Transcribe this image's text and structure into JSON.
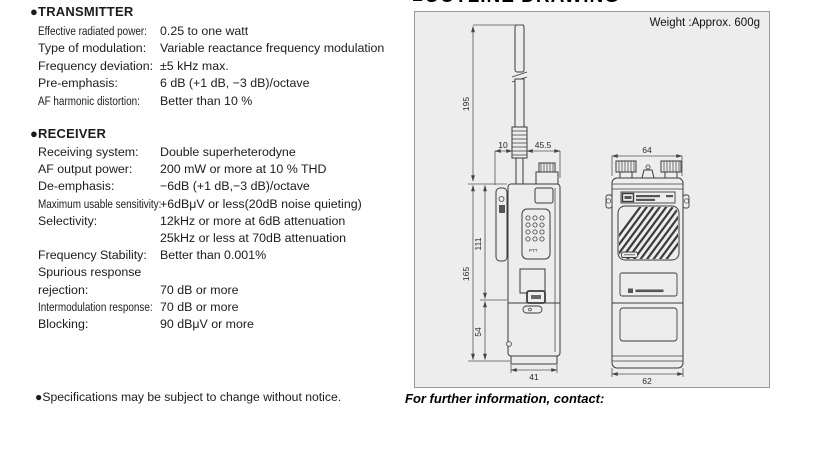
{
  "page": {
    "outline_header": "■OUTLINE DRAWING",
    "weight_note": "Weight :Approx. 600g",
    "footnote": "●Specifications may be subject to change without notice.",
    "contact_note": "For further information, contact:"
  },
  "transmitter": {
    "title": "●TRANSMITTER",
    "rows": [
      {
        "label": "Effective radiated power:",
        "value": "0.25 to one watt"
      },
      {
        "label": "Type of modulation:",
        "value": "Variable reactance frequency modulation"
      },
      {
        "label": "Frequency deviation:",
        "value": "±5 kHz max."
      },
      {
        "label": "Pre-emphasis:",
        "value": "6 dB (+1 dB, −3 dB)/octave"
      },
      {
        "label": "AF harmonic distortion:",
        "value": "Better than 10 %"
      }
    ]
  },
  "receiver": {
    "title": "●RECEIVER",
    "rows": [
      {
        "label": "Receiving system:",
        "value": "Double superheterodyne"
      },
      {
        "label": "AF output power:",
        "value": "200 mW or more at 10 % THD"
      },
      {
        "label": "De-emphasis:",
        "value": "−6dB (+1 dB,−3 dB)/octave"
      },
      {
        "label": "Maximum usable sensitivity:",
        "value": "+6dBμV or less(20dB noise quieting)"
      },
      {
        "label": "Selectivity:",
        "value": "12kHz or more at 6dB attenuation"
      },
      {
        "label": "",
        "value": "25kHz or less at 70dB attenuation"
      },
      {
        "label": "Frequency Stability:",
        "value": "Better than 0.001%"
      },
      {
        "label": "Spurious response",
        "value": ""
      },
      {
        "label": "rejection:",
        "value": "70 dB or more"
      },
      {
        "label": "Intermodulation response:",
        "value": "70 dB or more"
      },
      {
        "label": "Blocking:",
        "value": "90 dBμV or more"
      }
    ]
  },
  "drawing": {
    "dims": {
      "antenna_length": "195",
      "antenna_offset": "10",
      "side_top_width": "45.5",
      "front_top_width": "64",
      "upper_body_height": "111",
      "body_height": "165",
      "lower_body_height": "54",
      "side_bottom_width": "41",
      "front_bottom_width": "62"
    },
    "keypad_label": "PTT"
  }
}
